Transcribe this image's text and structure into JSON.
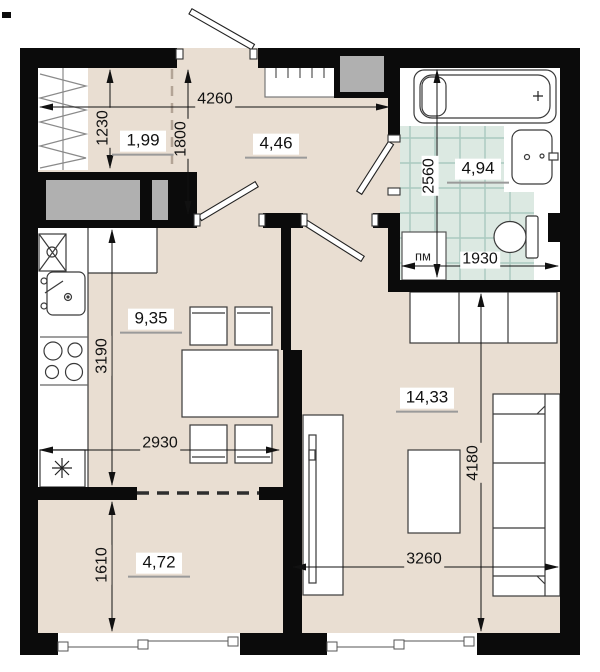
{
  "plan": {
    "areas": {
      "wardrobe": "1,99",
      "hallway": "4,46",
      "bathroom": "4,94",
      "kitchen": "9,35",
      "living_room": "14,33",
      "balcony": "4,72"
    },
    "dims": {
      "hallway_width": "4260",
      "wardrobe_depth": "1230",
      "hallway_depth": "1800",
      "bathroom_depth": "2560",
      "bathroom_width": "1930",
      "kitchen_depth": "3190",
      "kitchen_width": "2930",
      "living_room_depth": "4180",
      "living_room_width": "3260",
      "balcony_depth": "1610"
    },
    "labels": {
      "washing_machine": "пм"
    },
    "colors": {
      "floor": "#e9ded2",
      "wall": "#0b0b0b",
      "shaft": "#b0b0b0",
      "tile": "#dce9e2",
      "tile_grid": "#a9c9bf",
      "outline": "#3a3a3a",
      "dimension": "#111111",
      "area_underline": "#9a9a9a"
    }
  }
}
